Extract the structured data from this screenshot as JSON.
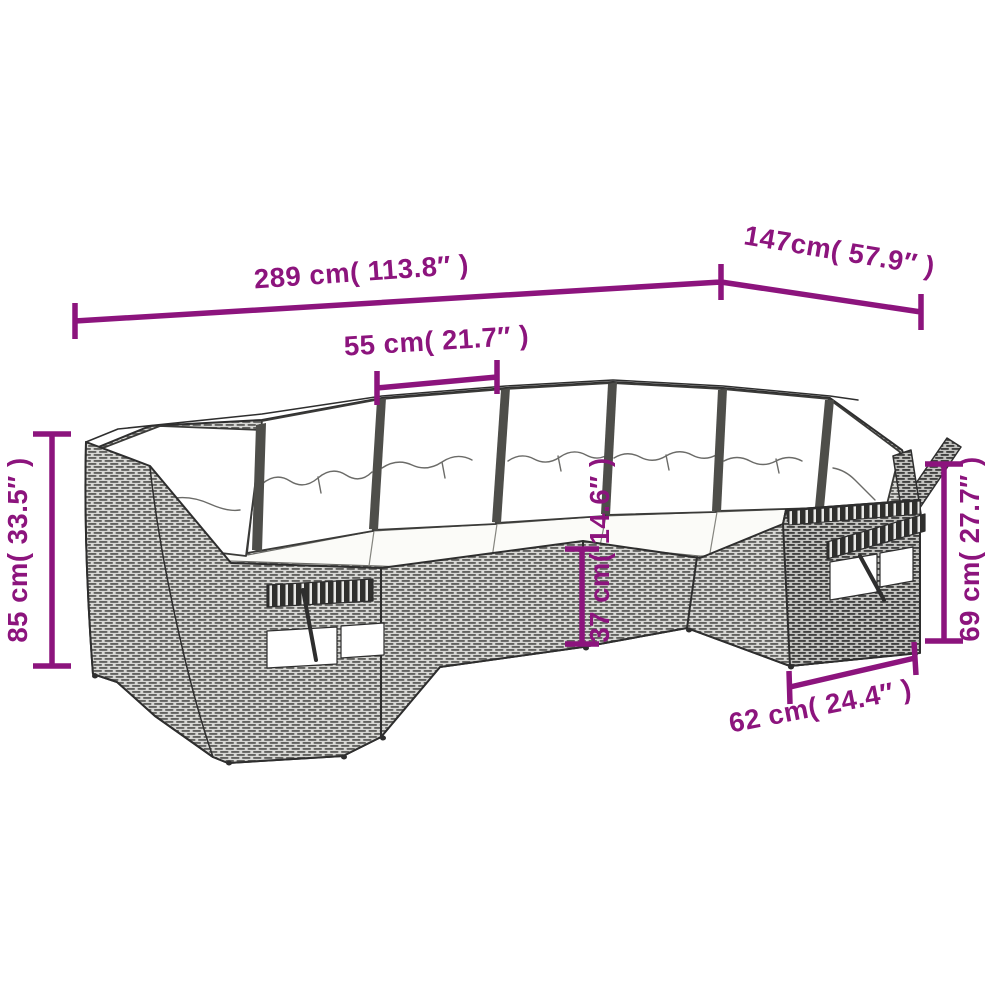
{
  "diagram": {
    "type": "product-dimension-diagram",
    "subject": "rattan corner sofa set with cushions",
    "accent_color": "#8c147d",
    "line_art_color": "#2e2e2e",
    "dimensions": {
      "total_width": {
        "label": "289 cm( 113.8″ )"
      },
      "right_depth": {
        "label": "147cm( 57.9″ )"
      },
      "seat_width": {
        "label": "55 cm( 21.7″ )"
      },
      "total_height": {
        "label": "85 cm( 33.5″ )"
      },
      "arm_height": {
        "label": "69 cm( 27.7″ )"
      },
      "seat_height": {
        "label": "37 cm( 14.6″ )"
      },
      "arm_depth": {
        "label": "62 cm( 24.4″ )"
      }
    }
  }
}
